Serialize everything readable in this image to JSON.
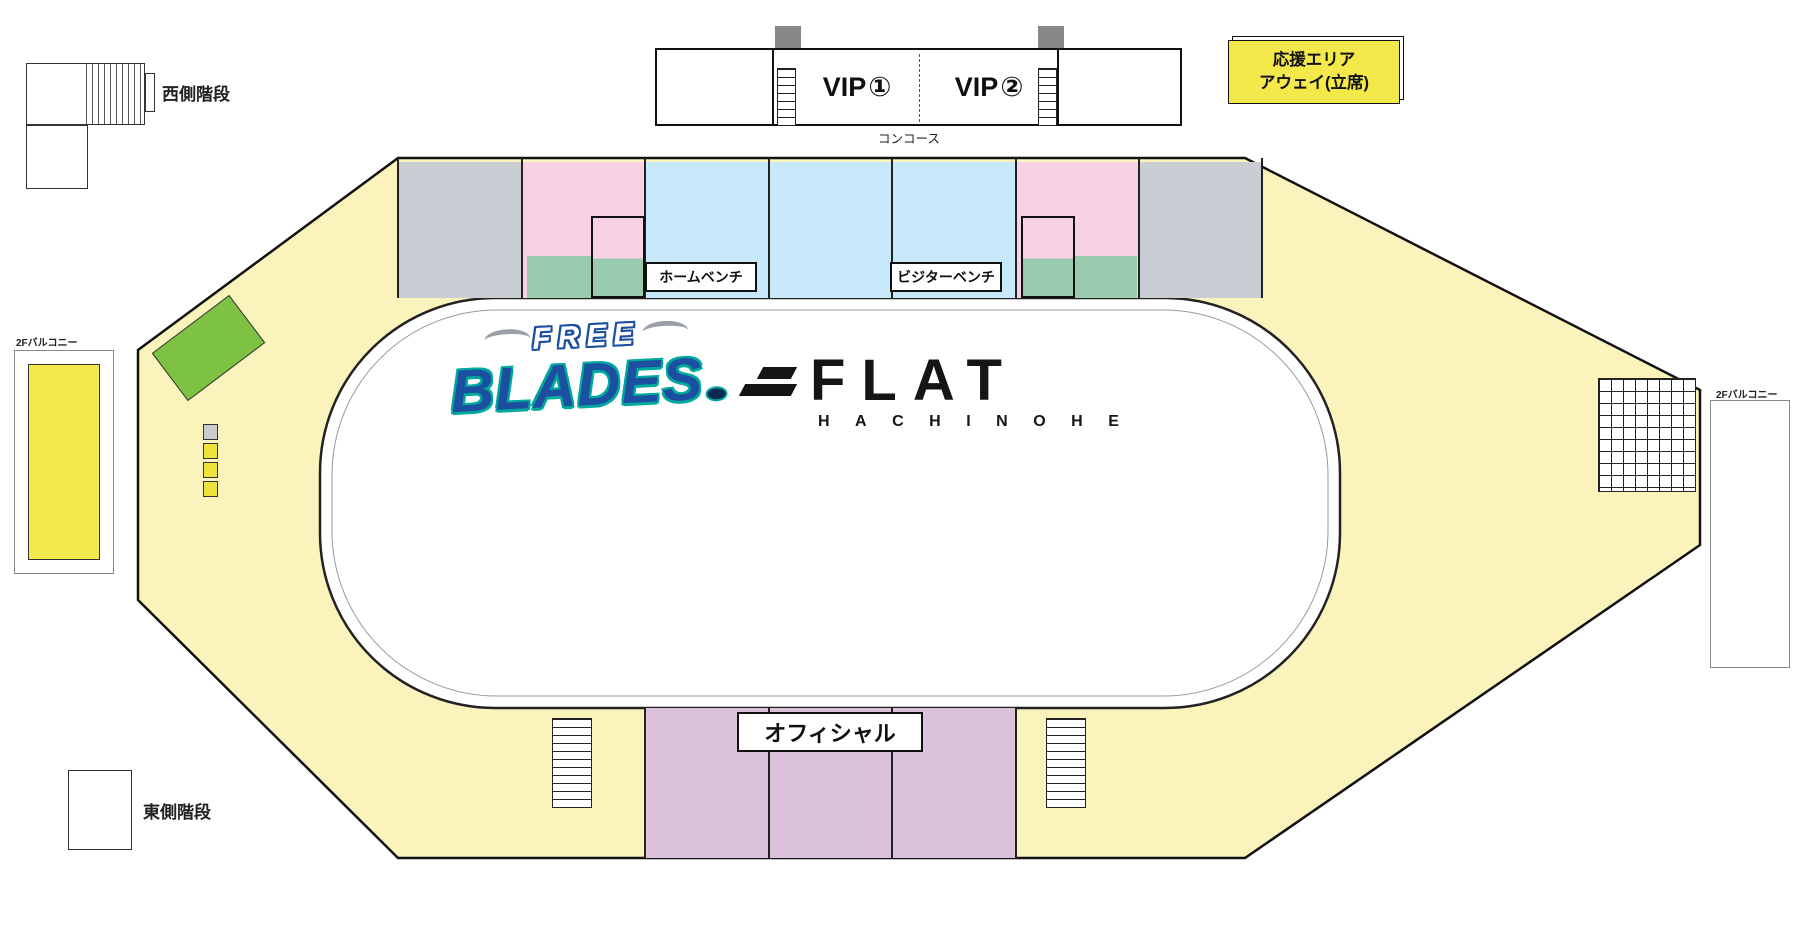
{
  "stairs": {
    "west": "西側階段",
    "east": "東側階段"
  },
  "concourse": "コンコース",
  "official": "オフィシャル",
  "benches": {
    "home": "ホームベンチ",
    "visitor": "ビジターベンチ"
  },
  "away_area": {
    "line1": "応援エリア",
    "line2": "アウェイ(立席)"
  },
  "home_area": {
    "lines": [
      "応援",
      "エリア",
      "ホーム",
      "(立席)"
    ]
  },
  "balcony_label": "2Fバルコニー",
  "balcony_pair_boxes": [
    {
      "label": "ペアシート",
      "num": "①"
    },
    {
      "label": "ペアシート",
      "num": "②"
    },
    {
      "label": "ペアシート",
      "num": "③"
    },
    {
      "label": "ペアシート",
      "num": "④"
    }
  ],
  "vip": {
    "rooms": [
      {
        "name": "VIP",
        "num": "①"
      },
      {
        "name": "VIP",
        "num": "②"
      }
    ],
    "pair_box_lines": [
      "VIP",
      "ペアシート"
    ],
    "pair_box_nums": [
      "①",
      "②",
      "③",
      "④",
      "⑤",
      "⑥"
    ]
  },
  "logo_blades": {
    "top": "FREE",
    "main": "BLADES"
  },
  "logo_flat": {
    "main": "FLAT",
    "sub": "HACHINOHE"
  },
  "legend": {
    "cells": [
      [
        {
          "label": "VIP",
          "color": "#FFFFFF",
          "big": true
        },
        {
          "label": "写真付きペアシート",
          "color": "#C9CDD9"
        },
        {
          "label": "ウエスト指定S",
          "color": "#C9E7F8"
        },
        {
          "label": "イースト指定A",
          "color": "#DCC3DB"
        }
      ],
      [
        {
          "label": "ペア",
          "color": "#CE2A80"
        },
        {
          "label": "ガラス越し2ショットシート",
          "color": "#8CC152"
        },
        {
          "label": "ウエスト指定A",
          "color": "#FAD6E8"
        },
        {
          "label": "自由席",
          "color": "#EEF0CF"
        }
      ],
      [
        {
          "label": "ハイタッチシート",
          "color": "#99CBAE"
        },
        {
          "label": "ゴール裏シート",
          "suffix": "(ファンクラブ限定)",
          "color": "#DFD83F"
        },
        {
          "label": "ウエスト指定B",
          "color": "#C4C6C8"
        },
        {
          "label": "応援エリア",
          "color": "#F0E23C"
        }
      ]
    ]
  },
  "tier_legend": [
    {
      "label": "上段シート",
      "color": "#F15A29"
    },
    {
      "label": "中段シート",
      "color": "#3EB549"
    },
    {
      "label": "下段シート",
      "color": "#29ABE2"
    }
  ],
  "seat_colors": {
    "orange": "#F15A29",
    "green": "#3EB549",
    "blue": "#29ABE2",
    "lightblue": "#A9DCF0",
    "gray": "#D3D3D6"
  },
  "section_labels": [
    {
      "id": "W1",
      "x": 99,
      "y": 266,
      "bg": "#F6EFA0"
    },
    {
      "id": "W2",
      "x": 171,
      "y": 191,
      "bg": "#F6EFA0"
    },
    {
      "id": "W3",
      "x": 330,
      "y": 147,
      "bg": "#F6EFA0"
    },
    {
      "id": "W4",
      "x": 460,
      "y": 147,
      "bg": "#C8CACF"
    },
    {
      "id": "W5",
      "x": 583,
      "y": 147,
      "bg": "#F8D2E3"
    },
    {
      "id": "W6",
      "x": 707,
      "y": 147,
      "bg": "#C8E9FA"
    },
    {
      "id": "W7",
      "x": 830,
      "y": 147,
      "bg": "#C8E9FA"
    },
    {
      "id": "W8",
      "x": 954,
      "y": 147,
      "bg": "#C8E9FA"
    },
    {
      "id": "W9",
      "x": 1077,
      "y": 147,
      "bg": "#F8D2E3"
    },
    {
      "id": "W10",
      "x": 1200,
      "y": 147,
      "bg": "#C8CACF"
    },
    {
      "id": "W11",
      "x": 1324,
      "y": 147,
      "bg": "#FFFFFF"
    },
    {
      "id": "W12",
      "x": 1447,
      "y": 208,
      "bg": "#F6EFA0"
    },
    {
      "id": "E1",
      "x": 104,
      "y": 752,
      "bg": "#F6EFA0"
    },
    {
      "id": "E2",
      "x": 170,
      "y": 806,
      "bg": "#F6EFA0"
    },
    {
      "id": "E3",
      "x": 330,
      "y": 877,
      "bg": "#F6EFA0"
    },
    {
      "id": "E4",
      "x": 460,
      "y": 877,
      "bg": "#F6EFA0"
    },
    {
      "id": "E5",
      "x": 583,
      "y": 877,
      "bg": "#F6EFA0"
    },
    {
      "id": "E6",
      "x": 707,
      "y": 877,
      "bg": "#DCC3DB"
    },
    {
      "id": "E7",
      "x": 830,
      "y": 877,
      "bg": "#DCC3DB"
    },
    {
      "id": "E8",
      "x": 954,
      "y": 877,
      "bg": "#DCC3DB"
    },
    {
      "id": "E9",
      "x": 1077,
      "y": 877,
      "bg": "#F6EFA0"
    },
    {
      "id": "E10",
      "x": 1200,
      "y": 877,
      "bg": "#F6EFA0"
    },
    {
      "id": "E11",
      "x": 1324,
      "y": 877,
      "bg": "#F6EFA0"
    },
    {
      "id": "E12",
      "x": 1447,
      "y": 716,
      "bg": "#F6EFA0"
    }
  ],
  "seat_sections": [
    {
      "id": "W4",
      "x": 402,
      "y": 166,
      "w": 118,
      "side": "left",
      "pitch": 19,
      "rows": [
        [
          7,
          "orange",
          12
        ],
        [
          6,
          "green",
          12
        ],
        [
          5,
          "green",
          12
        ],
        [
          4,
          "green",
          12
        ],
        [
          3,
          "green",
          12
        ],
        [
          2,
          "blue",
          12
        ],
        [
          1,
          "blue",
          12
        ]
      ]
    },
    {
      "id": "W5",
      "x": 527,
      "y": 166,
      "w": 116,
      "side": "none",
      "pitch": 19,
      "rows": [
        [
          7,
          "orange",
          12
        ],
        [
          6,
          "green",
          12
        ],
        [
          5,
          "green",
          6
        ],
        [
          4,
          "green",
          6
        ],
        [
          3,
          "lightblue",
          6
        ],
        [
          2,
          "lightblue",
          6
        ]
      ]
    },
    {
      "id": "W6",
      "x": 650,
      "y": 166,
      "w": 122,
      "side": "left",
      "pitch": 19,
      "rows": [
        [
          7,
          "orange",
          12
        ],
        [
          6,
          "green",
          12
        ],
        [
          5,
          "green",
          12
        ],
        [
          4,
          "blue",
          12
        ],
        [
          3,
          "blue",
          12
        ]
      ]
    },
    {
      "id": "W7",
      "x": 774,
      "y": 166,
      "w": 122,
      "side": "left",
      "pitch": 19,
      "rows": [
        [
          7,
          "orange",
          12
        ],
        [
          6,
          "green",
          12
        ],
        [
          5,
          "green",
          12
        ],
        [
          4,
          "blue",
          12
        ],
        [
          3,
          "blue",
          12
        ]
      ]
    },
    {
      "id": "W8",
      "x": 897,
      "y": 166,
      "w": 122,
      "side": "left",
      "pitch": 19,
      "rows": [
        [
          7,
          "orange",
          12
        ],
        [
          6,
          "green",
          12
        ],
        [
          5,
          "green",
          12
        ],
        [
          4,
          "blue",
          12
        ],
        [
          3,
          "blue",
          12
        ]
      ]
    },
    {
      "id": "W9",
      "x": 1021,
      "y": 166,
      "w": 116,
      "side": "right",
      "align": "right",
      "pitch": 19,
      "rows": [
        [
          7,
          "orange",
          12
        ],
        [
          6,
          "green",
          12
        ],
        [
          5,
          "green",
          6
        ],
        [
          4,
          "green",
          6
        ],
        [
          3,
          "lightblue",
          6
        ],
        [
          2,
          "lightblue",
          6
        ]
      ]
    },
    {
      "id": "W10",
      "x": 1142,
      "y": 166,
      "w": 118,
      "side": "right",
      "align": "right",
      "pitch": 19,
      "rows": [
        [
          7,
          "orange",
          12
        ],
        [
          6,
          "green",
          12
        ],
        [
          5,
          "green",
          12
        ],
        [
          4,
          "green",
          12
        ],
        [
          3,
          "green",
          12
        ],
        [
          2,
          "blue",
          12
        ],
        [
          1,
          "blue",
          12
        ]
      ]
    },
    {
      "id": "W3-strip",
      "x": 341,
      "y": 170,
      "w": 56,
      "side": "none",
      "pitch": 21,
      "rows": [
        [
          null,
          "gray",
          5,
          8
        ],
        [
          null,
          "gray",
          5,
          8
        ],
        [
          null,
          "gray",
          5,
          8
        ],
        [
          null,
          "gray",
          5,
          8
        ],
        [
          null,
          "gray",
          5,
          8
        ],
        [
          null,
          "gray",
          5,
          8
        ]
      ]
    },
    {
      "id": "W11-strip",
      "x": 1266,
      "y": 170,
      "w": 56,
      "side": "none",
      "pitch": 21,
      "rows": [
        [
          null,
          "gray",
          5,
          1
        ],
        [
          null,
          "gray",
          5,
          1
        ],
        [
          null,
          "gray",
          5,
          1
        ],
        [
          null,
          "gray",
          5,
          1
        ],
        [
          null,
          "gray",
          5,
          1
        ],
        [
          null,
          "gray",
          5,
          1
        ]
      ]
    },
    {
      "id": "E4",
      "x": 404,
      "y": 722,
      "w": 118,
      "side": "right",
      "pitch": 18,
      "rows": [
        [
          1,
          "gray",
          12
        ],
        [
          2,
          "gray",
          12
        ],
        [
          3,
          "gray",
          12
        ],
        [
          4,
          "gray",
          12
        ],
        [
          5,
          "gray",
          12
        ],
        [
          6,
          "gray",
          12
        ],
        [
          7,
          "gray",
          12
        ]
      ]
    },
    {
      "id": "E5",
      "x": 526,
      "y": 722,
      "w": 118,
      "side": "right",
      "pitch": 18,
      "rows": [
        [
          1,
          "gray",
          12
        ],
        [
          2,
          "gray",
          12
        ],
        [
          3,
          "gray",
          12
        ],
        [
          4,
          "gray",
          12
        ],
        [
          5,
          "gray",
          12
        ],
        [
          6,
          "gray",
          12
        ],
        [
          7,
          "gray",
          12
        ]
      ]
    },
    {
      "id": "E6",
      "x": 650,
      "y": 762,
      "w": 122,
      "side": "right",
      "pitch": 18,
      "rows": [
        [
          3,
          "blue",
          12
        ],
        [
          4,
          "blue",
          12
        ],
        [
          5,
          "green",
          12
        ],
        [
          6,
          "green",
          12
        ],
        [
          7,
          "orange",
          12
        ]
      ]
    },
    {
      "id": "E7",
      "x": 774,
      "y": 762,
      "w": 122,
      "side": "right",
      "pitch": 18,
      "rows": [
        [
          3,
          "blue",
          12
        ],
        [
          4,
          "blue",
          12
        ],
        [
          5,
          "green",
          12
        ],
        [
          6,
          "green",
          12
        ],
        [
          7,
          "orange",
          12
        ]
      ]
    },
    {
      "id": "E8",
      "x": 897,
      "y": 762,
      "w": 122,
      "side": "left",
      "pitch": 18,
      "rows": [
        [
          3,
          "blue",
          12
        ],
        [
          4,
          "blue",
          12
        ],
        [
          5,
          "green",
          12
        ],
        [
          6,
          "green",
          12
        ],
        [
          7,
          "orange",
          12
        ]
      ]
    },
    {
      "id": "E9",
      "x": 1020,
      "y": 722,
      "w": 118,
      "side": "left",
      "pitch": 18,
      "rows": [
        [
          1,
          "gray",
          12
        ],
        [
          2,
          "gray",
          12
        ],
        [
          3,
          "gray",
          12
        ],
        [
          4,
          "gray",
          12
        ],
        [
          5,
          "gray",
          12
        ],
        [
          6,
          "gray",
          12
        ],
        [
          7,
          "gray",
          12
        ]
      ]
    },
    {
      "id": "E10",
      "x": 1144,
      "y": 722,
      "w": 118,
      "side": "left",
      "pitch": 18,
      "rows": [
        [
          1,
          "gray",
          12
        ],
        [
          2,
          "gray",
          12
        ],
        [
          3,
          "gray",
          12
        ],
        [
          4,
          "gray",
          12
        ],
        [
          5,
          "gray",
          12
        ],
        [
          6,
          "gray",
          12
        ],
        [
          7,
          "gray",
          12
        ]
      ]
    },
    {
      "id": "NW-wing",
      "x": 95,
      "y": 190,
      "w": 310,
      "rot": -37,
      "big": true,
      "side": "right",
      "pitch": 22,
      "rows": [
        [
          3,
          "gray",
          13
        ],
        [
          4,
          "gray",
          13
        ],
        [
          5,
          "gray",
          13
        ],
        [
          6,
          "gray",
          13
        ],
        [
          7,
          "gray",
          13
        ]
      ]
    },
    {
      "id": "NE-wing",
      "x": 1300,
      "y": 210,
      "w": 390,
      "rot": 27,
      "big": true,
      "side": "left",
      "pitch": 22,
      "rows": [
        [
          3,
          "gray",
          16
        ],
        [
          4,
          "gray",
          16
        ],
        [
          5,
          "gray",
          16
        ],
        [
          6,
          "gray",
          16
        ],
        [
          7,
          "gray",
          16
        ]
      ]
    },
    {
      "id": "SW-wing",
      "x": 95,
      "y": 640,
      "w": 310,
      "rot": 37,
      "big": true,
      "side": "right",
      "pitch": 22,
      "rows": [
        [
          3,
          "gray",
          13
        ],
        [
          4,
          "gray",
          13
        ],
        [
          5,
          "gray",
          13
        ],
        [
          6,
          "gray",
          13
        ],
        [
          7,
          "gray",
          13
        ]
      ]
    },
    {
      "id": "SE-wing",
      "x": 1295,
      "y": 628,
      "w": 390,
      "rot": -27,
      "big": true,
      "side": "left",
      "pitch": 22,
      "rows": [
        [
          3,
          "gray",
          16
        ],
        [
          4,
          "gray",
          16
        ],
        [
          5,
          "gray",
          16
        ],
        [
          6,
          "gray",
          16
        ],
        [
          7,
          "gray",
          16
        ]
      ]
    }
  ]
}
